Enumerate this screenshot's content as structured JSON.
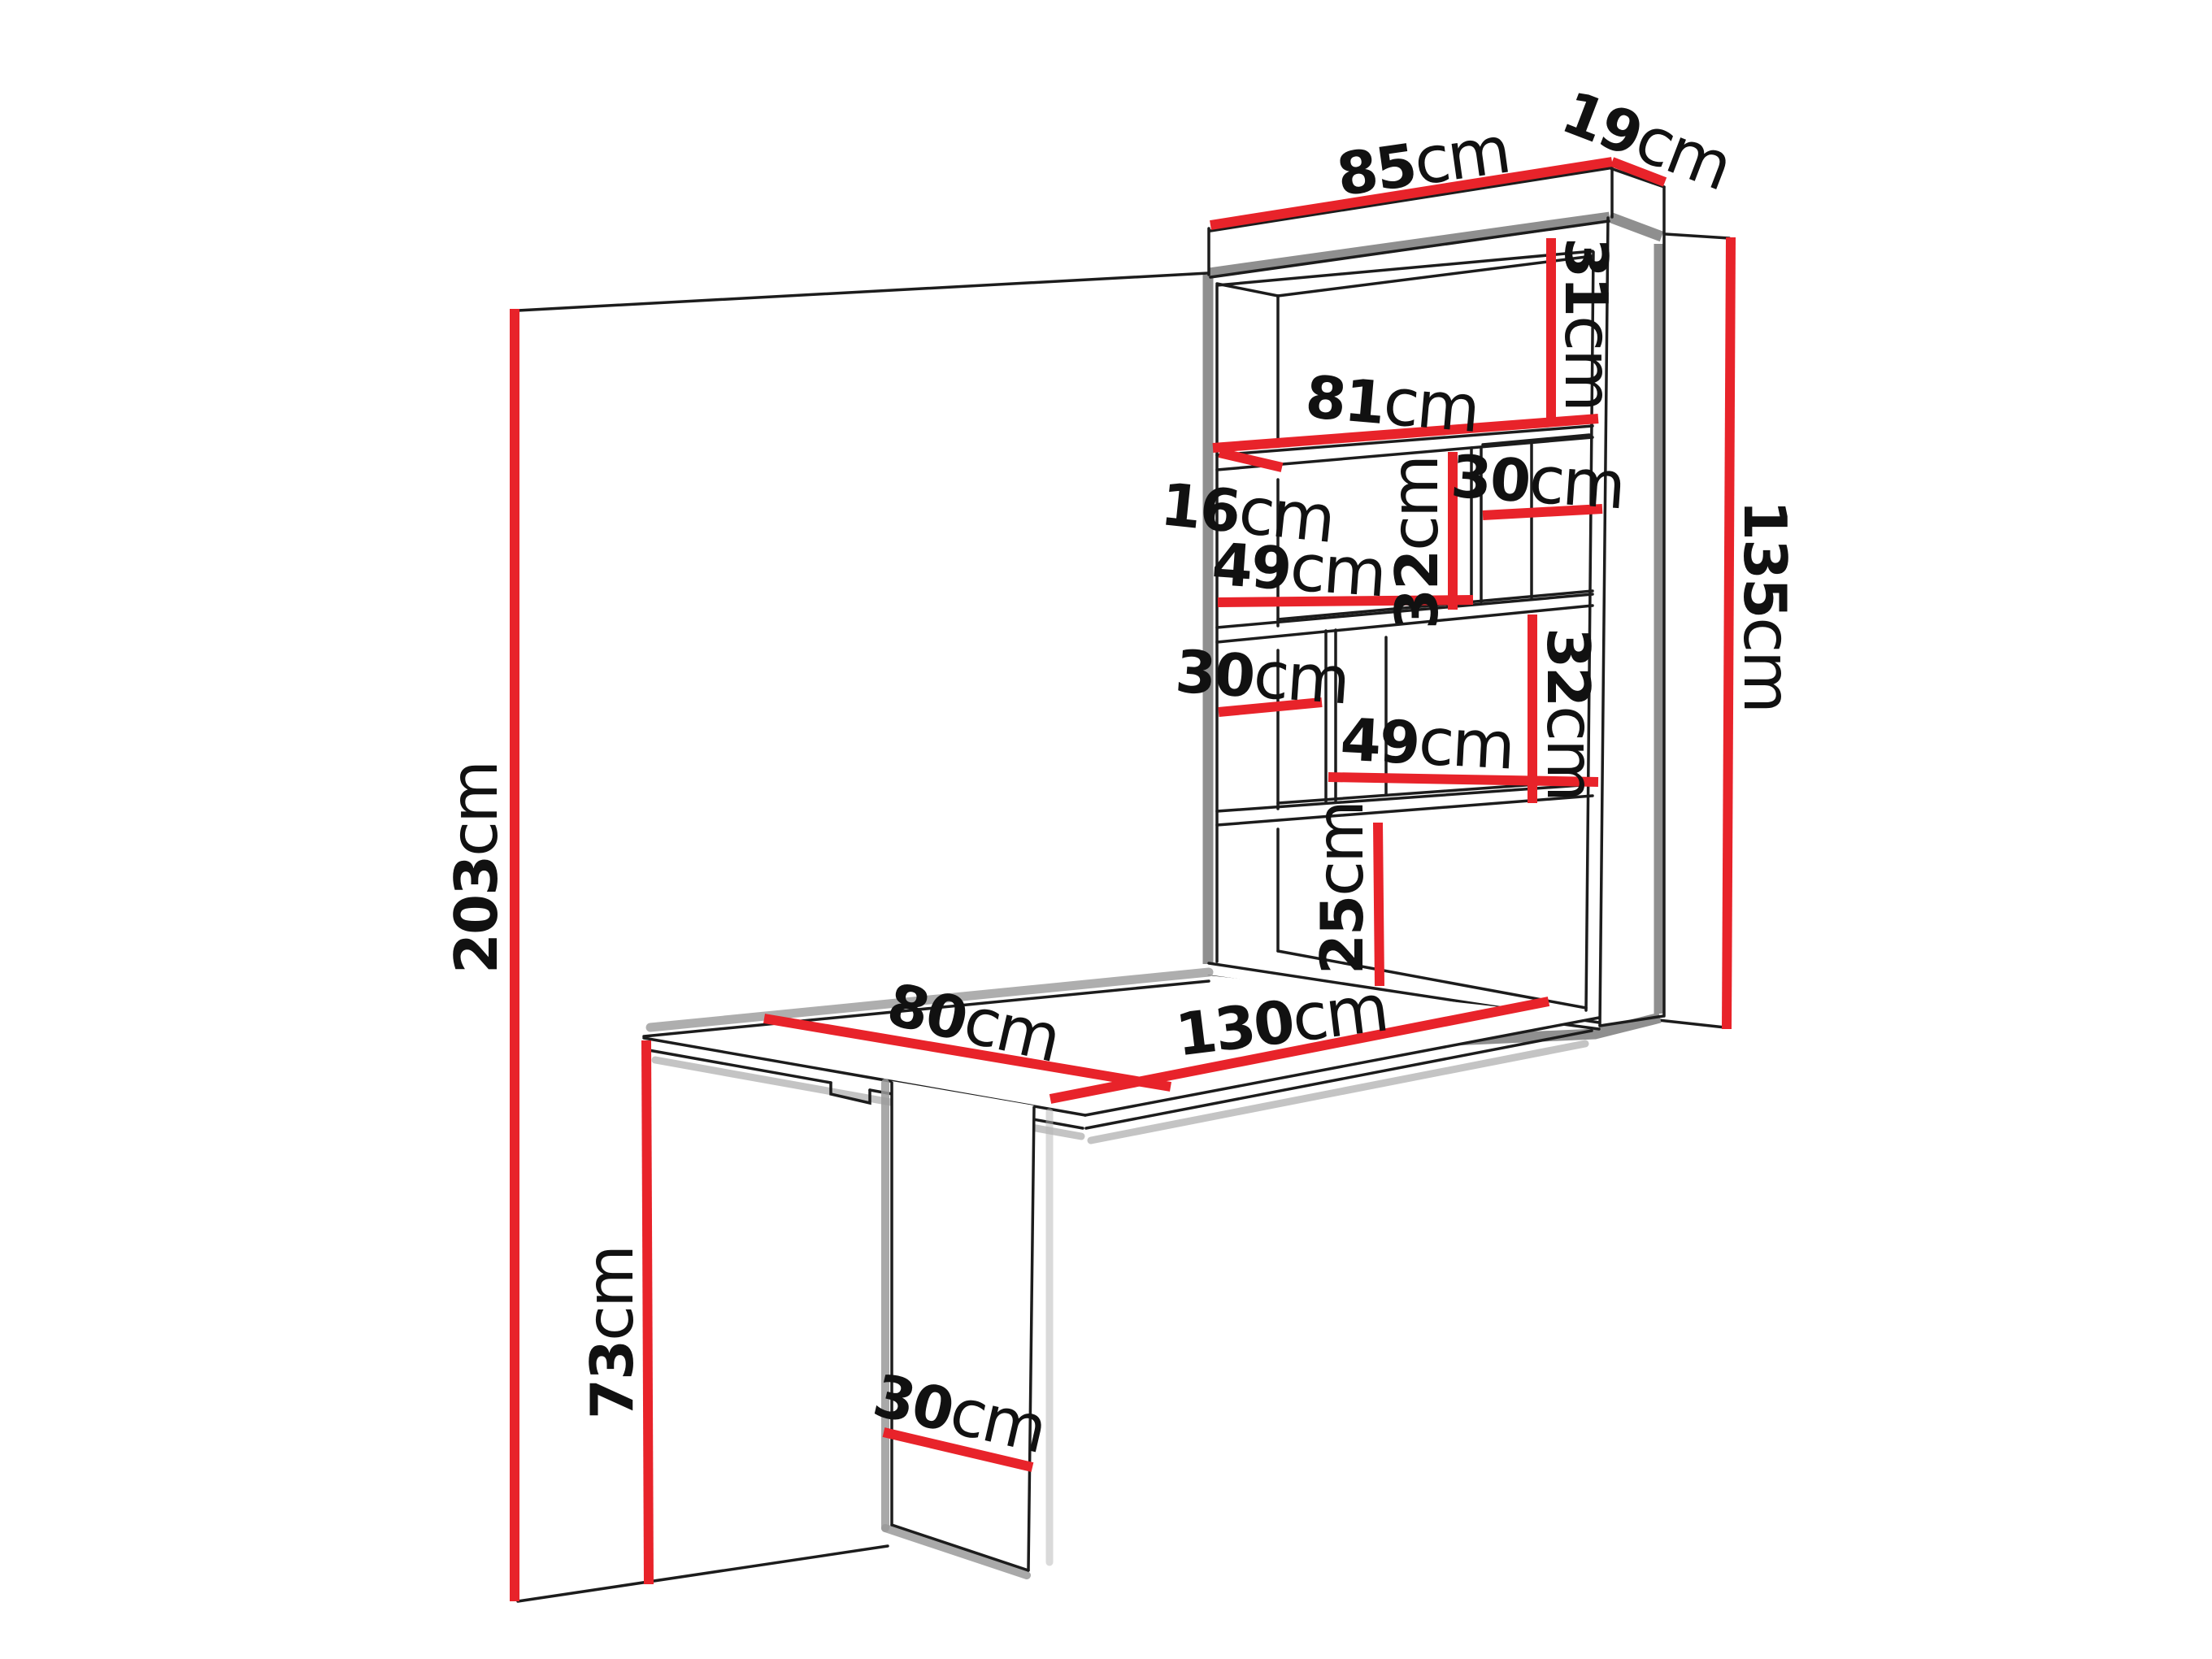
{
  "diagram": {
    "type": "furniture-dimension-drawing",
    "subject": "wall-mounted fold-out desk with shelving unit",
    "unit": "cm",
    "colors": {
      "dimension_line": "#e8232a",
      "outline": "#1c1c1c",
      "shadow": "#8f8f8f",
      "background": "#ffffff"
    },
    "dims": {
      "cabinet_width": {
        "value": "85",
        "unit": "cm"
      },
      "cabinet_depth": {
        "value": "19",
        "unit": "cm"
      },
      "top_compartment_h": {
        "value": "31",
        "unit": "cm"
      },
      "shelf_length": {
        "value": "81",
        "unit": "cm"
      },
      "shelf_depth": {
        "value": "16",
        "unit": "cm"
      },
      "upper_right_w": {
        "value": "30",
        "unit": "cm"
      },
      "upper_mid_w": {
        "value": "49",
        "unit": "cm"
      },
      "upper_mid_h": {
        "value": "32",
        "unit": "cm"
      },
      "cabinet_height": {
        "value": "135",
        "unit": "cm"
      },
      "lower_left_w": {
        "value": "30",
        "unit": "cm"
      },
      "lower_mid_h": {
        "value": "32",
        "unit": "cm"
      },
      "lower_mid_w": {
        "value": "49",
        "unit": "cm"
      },
      "bottom_compartment_h": {
        "value": "25",
        "unit": "cm"
      },
      "wall_height": {
        "value": "203",
        "unit": "cm"
      },
      "table_width": {
        "value": "80",
        "unit": "cm"
      },
      "table_length": {
        "value": "130",
        "unit": "cm"
      },
      "leg_height": {
        "value": "73",
        "unit": "cm"
      },
      "leg_width": {
        "value": "30",
        "unit": "cm"
      }
    }
  }
}
